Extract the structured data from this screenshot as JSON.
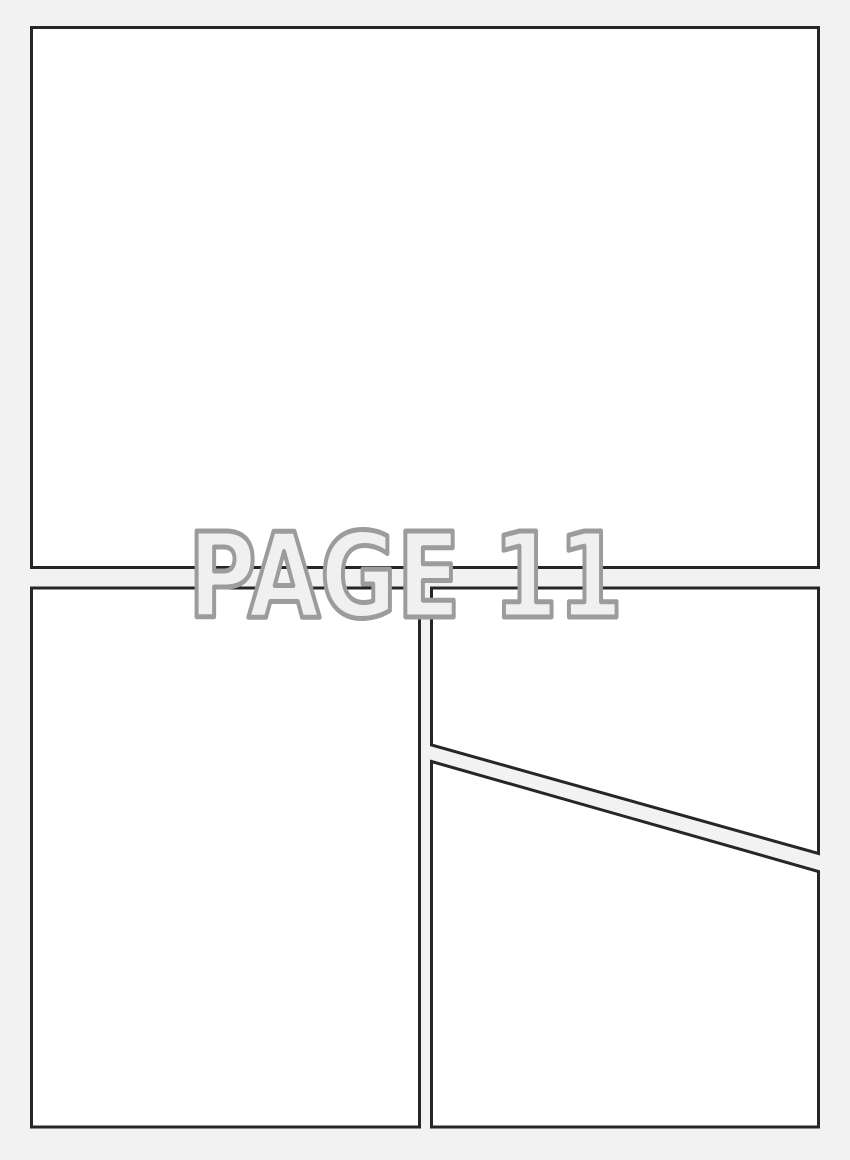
{
  "watermark": {
    "label": "PAGE 11"
  },
  "colors": {
    "background": "#f1f2f1",
    "panel_fill": "#ffffff",
    "panel_border": "#262626",
    "watermark_fill": "#f0f0f0",
    "watermark_stroke": "#9c9c9c"
  }
}
